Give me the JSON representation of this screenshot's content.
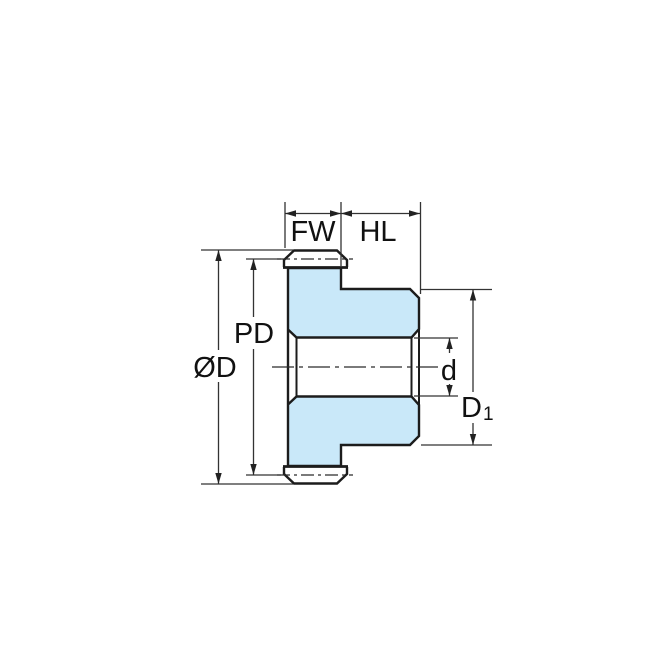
{
  "diagram": {
    "type": "technical-drawing",
    "subject": "spur gear cross-section with hub, dimension callouts",
    "labels": {
      "face_width": "FW",
      "hub_length": "HL",
      "pitch_diameter": "PD",
      "outside_diameter": "ØD",
      "bore_diameter": "d",
      "hub_diameter_main": "D",
      "hub_diameter_sub": "1"
    },
    "colors": {
      "part_fill": "#c9e8f9",
      "outline": "#1c1c1c",
      "dimension_lines": "#333333",
      "background": "#ffffff"
    }
  }
}
